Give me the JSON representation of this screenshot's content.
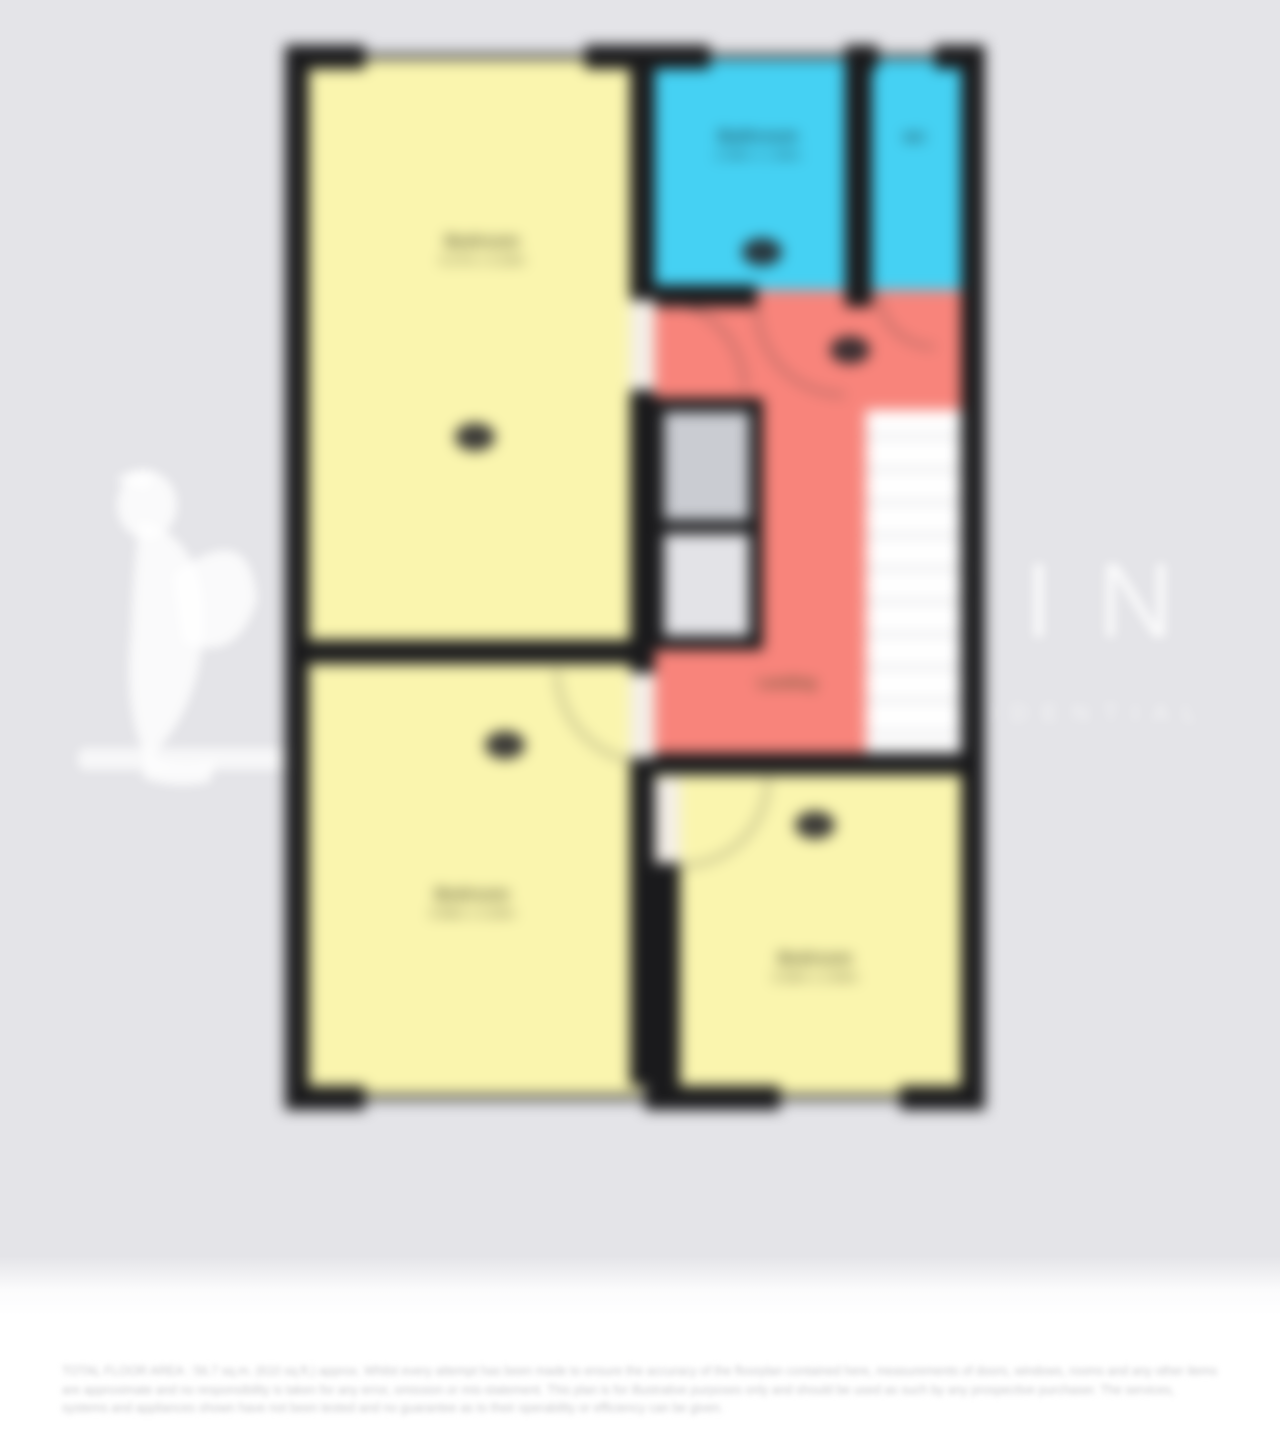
{
  "watermark": {
    "brand": "GRIFFIN",
    "tagline": "RESIDENTIAL",
    "logo": "griffin-logo"
  },
  "rooms": {
    "bedroom_main": {
      "name": "Bedroom",
      "dims": "4.27m x 3.23m"
    },
    "bathroom": {
      "name": "Bathroom",
      "dims": "2.08m x 1.96m"
    },
    "wc": {
      "name": "WC"
    },
    "landing": {
      "name": "Landing"
    },
    "bedroom_two": {
      "name": "Bedroom",
      "dims": "3.96m x 3.20m"
    },
    "bedroom_three": {
      "name": "Bedroom",
      "dims": "3.30m x 2.84m"
    }
  },
  "colors": {
    "room_yellow": "#faf5ae",
    "room_blue": "#45d1f3",
    "landing_red": "#f8847b",
    "wall_black": "#1a1a1c",
    "cupboard_gray": "#caccd2",
    "background": "#e4e4e8"
  },
  "disclaimer": {
    "line1": "TOTAL FLOOR AREA : 56.7 sq.m. (610 sq.ft.) approx.",
    "body": "Whilst every attempt has been made to ensure the accuracy of the floorplan contained here, measurements of doors, windows, rooms and any other items are approximate and no responsibility is taken for any error, omission or mis-statement. This plan is for illustrative purposes only and should be used as such by any prospective purchaser. The services, systems and appliances shown have not been tested and no guarantee as to their operability or efficiency can be given."
  }
}
